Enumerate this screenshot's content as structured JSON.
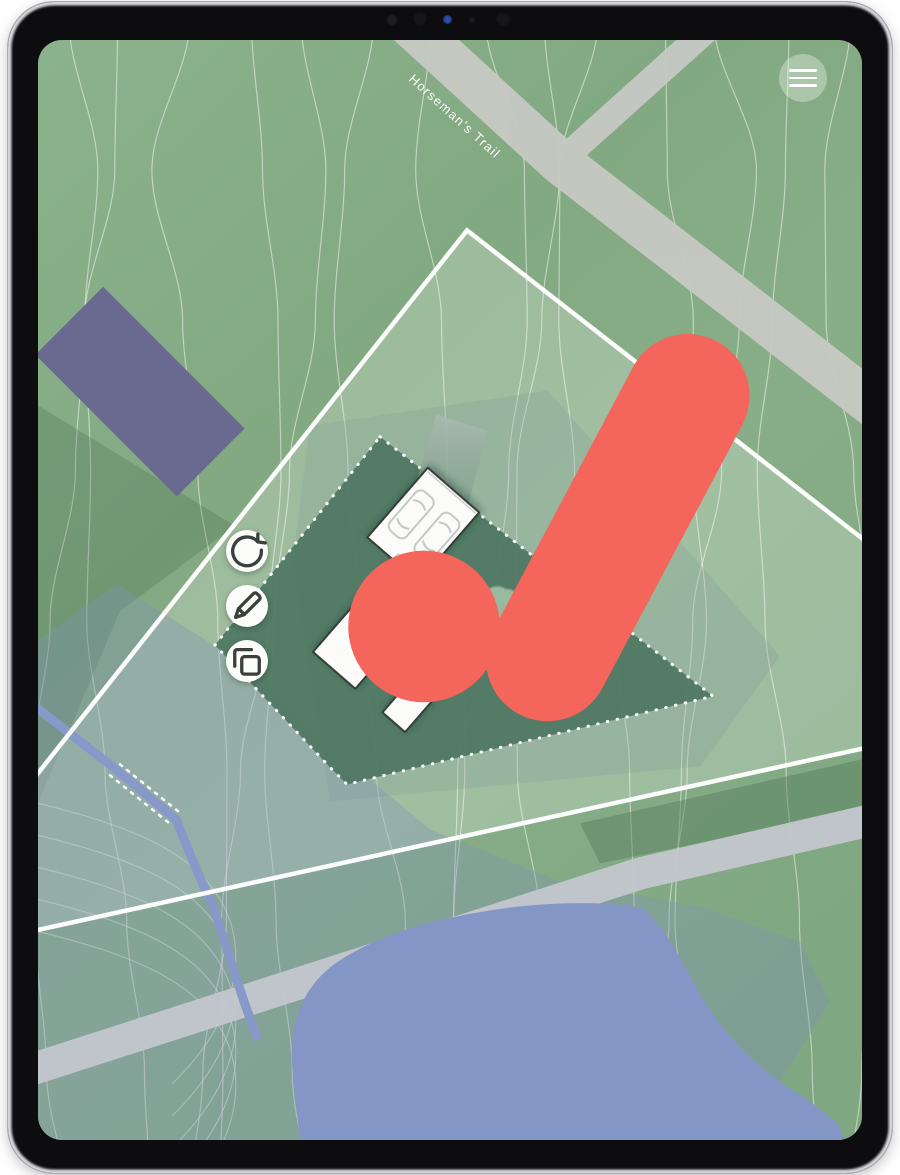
{
  "device": {
    "name": "tablet"
  },
  "branding": {
    "logo": "brand-mark",
    "accent": "#F4655C"
  },
  "topbar": {
    "menu_icon": "hamburger"
  },
  "map": {
    "road_label": "Horseman's Trail",
    "colors": {
      "base_green": "#86AD85",
      "lot_fill": "rgba(255,255,255,0.22)",
      "envelope_green": "#4D7662",
      "road_gray": "#C7C9C4",
      "road2_gray": "#C3C6CD",
      "water_blue": "#8496C5",
      "stream_blue": "#8799C9",
      "wetland_overlay": "rgba(128,146,183,0.35)",
      "building_purple": "#6A6A90",
      "contour": "rgba(250,252,248,0.5)",
      "boundary_white": "#FFFFFF"
    },
    "house": {
      "front_tag": "FRONT",
      "label": [
        "50 × 62",
        "1800 SF",
        "1-STORY"
      ]
    },
    "tools": [
      {
        "id": "rotate",
        "icon": "rotate-icon"
      },
      {
        "id": "edit",
        "icon": "pencil-icon"
      },
      {
        "id": "duplicate",
        "icon": "duplicate-icon"
      }
    ]
  }
}
